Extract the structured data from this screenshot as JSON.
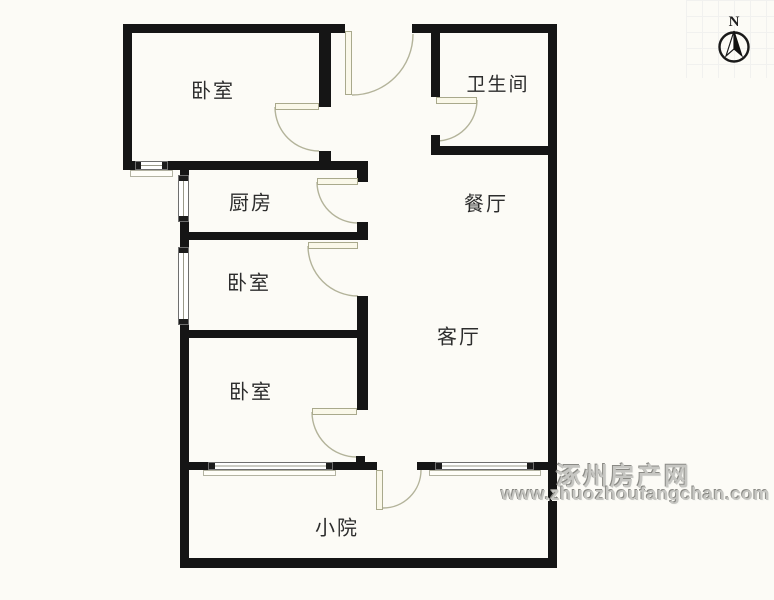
{
  "plan": {
    "rooms": [
      {
        "name": "bedroom-top-left",
        "label": "卧室"
      },
      {
        "name": "bathroom",
        "label": "卫生间"
      },
      {
        "name": "kitchen",
        "label": "厨房"
      },
      {
        "name": "dining-room",
        "label": "餐厅"
      },
      {
        "name": "bedroom-middle",
        "label": "卧室"
      },
      {
        "name": "living-room",
        "label": "客厅"
      },
      {
        "name": "bedroom-lower",
        "label": "卧室"
      },
      {
        "name": "yard",
        "label": "小院"
      }
    ]
  },
  "compass": {
    "label": "N"
  },
  "watermark": {
    "site_name": "涿州房产网",
    "site_url": "www.zhuozhoufangchan.com"
  },
  "colors": {
    "wall": "#151515",
    "background": "#fcfbf6",
    "door_swing": "#b3b39a",
    "watermark_gray": "#c6c6c2"
  }
}
